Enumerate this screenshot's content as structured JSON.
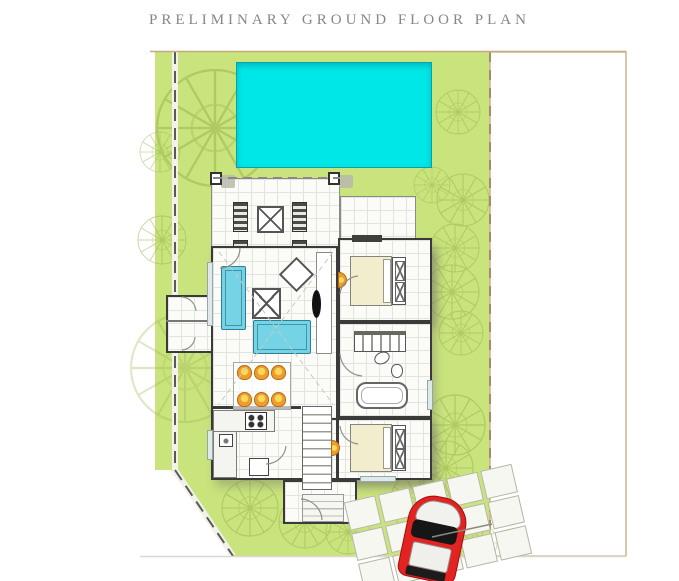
{
  "header": {
    "title": "PRELIMINARY GROUND FLOOR PLAN"
  },
  "colors": {
    "title_text": "#85868a",
    "lawn": "#c9e37d",
    "pool": "#00e7e7",
    "sofa": "#74d4e6",
    "dining_chair": "#f09c2c",
    "bed": "#f2eecd",
    "car": "#e32222",
    "wall": "#3a3a3a",
    "plot_border": "#c9a87c",
    "boundary": "#5a5a5a",
    "tree": "#97b04a"
  }
}
